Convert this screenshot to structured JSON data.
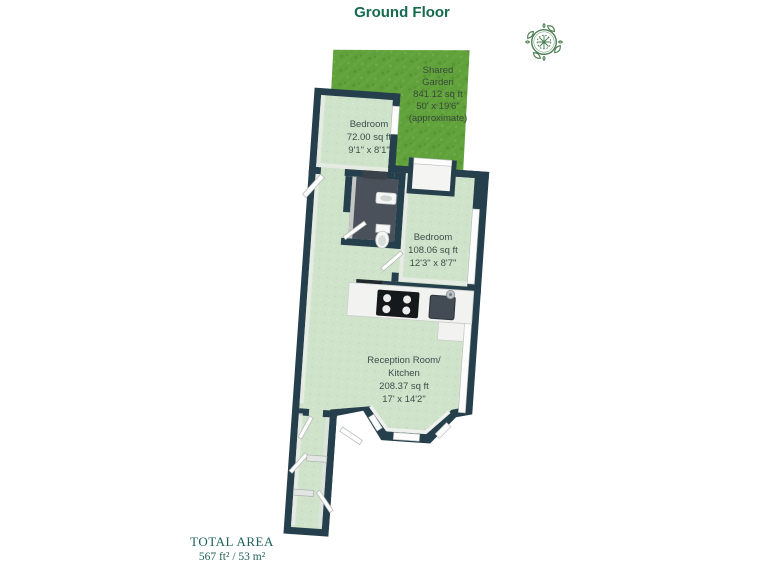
{
  "header": {
    "title": "Ground Floor"
  },
  "compass": {
    "icon": "compass-rose",
    "color": "#4e8055"
  },
  "floorplan": {
    "garden": {
      "name": "Shared Garden",
      "lines": [
        "Shared",
        "Garden",
        "841.12 sq ft",
        "50' x 19'6\"",
        "(approximate)"
      ]
    },
    "bedroom1": {
      "name": "Bedroom",
      "lines": [
        "Bedroom",
        "72.00 sq ft",
        "9'1\" x 8'1\""
      ]
    },
    "bedroom2": {
      "name": "Bedroom",
      "lines": [
        "Bedroom",
        "108.06 sq ft",
        "12'3\" x 8'7\""
      ]
    },
    "reception": {
      "name": "Reception Room / Kitchen",
      "lines": [
        "Reception Room/",
        "Kitchen",
        "208.37 sq ft",
        "17' x 14'2\""
      ]
    },
    "colors": {
      "wall": "#263f4c",
      "floor": "#cfe3cb",
      "grass": "#61a13c",
      "bathroom_floor": "#4a515a",
      "label_text": "#3b4f4b",
      "title_text": "#166a4f"
    }
  },
  "footer": {
    "label": "TOTAL AREA",
    "value": "567 ft² / 53 m²"
  }
}
